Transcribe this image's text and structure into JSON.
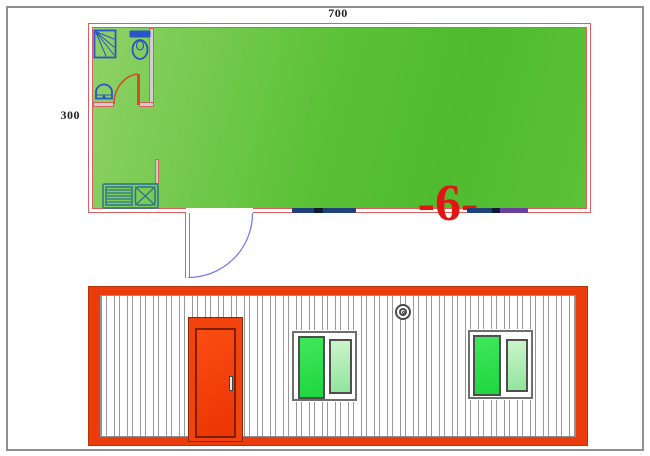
{
  "labels": {
    "plan_width": "700",
    "plan_height": "300",
    "unit_number": "-6-"
  },
  "plan": {
    "view": "floor-plan",
    "rooms": [
      "main-room",
      "bathroom",
      "kitchen-corner"
    ],
    "fixtures": [
      "shower",
      "toilet",
      "wash-basin",
      "kitchen-sink-counter"
    ],
    "openings": [
      "bathroom-door",
      "entry-door",
      "window-left",
      "window-right"
    ]
  },
  "elevation": {
    "view": "front-elevation",
    "features": [
      "corrugated-wall",
      "entry-door",
      "door-handle",
      "window-left",
      "window-right",
      "round-vent"
    ]
  },
  "colors": {
    "page-frame": "#8f8f8f",
    "text-dark": "#1f1f1f",
    "plan-red": "#dd5e5e",
    "wall-fill": "#cfcfcf",
    "floor-a": "#8fd266",
    "floor-b": "#5cc238",
    "floor-c": "#4fbb2e",
    "fixture-blue": "#2a55c8",
    "kitchen-teal": "#2b7292",
    "bath-door": "#cc5226",
    "entry-door": "#7b7bea",
    "window-navy": "#20407a",
    "window-tick": "#101a30",
    "window-purple": "#6b3fa0",
    "label-red": "#e21414",
    "elev-frame": "#ea3c0c",
    "elev-frame-edge": "#b53307",
    "elev-door": "#f2430c",
    "elev-door-dark": "#8d2403",
    "door-panel-a": "#fb4d12",
    "door-panel-b": "#ea3404",
    "panel-border": "#7c2001",
    "corrugation": "#989898",
    "win-frame": "#6f6f6f",
    "pane-border": "#4e4e4e",
    "pane-bright-a": "#3fe75c",
    "pane-bright-b": "#1fd63f",
    "pane-light-a": "#ccf5cc",
    "pane-light-b": "#8fe49b",
    "vent-gray": "#4a4a4a"
  }
}
